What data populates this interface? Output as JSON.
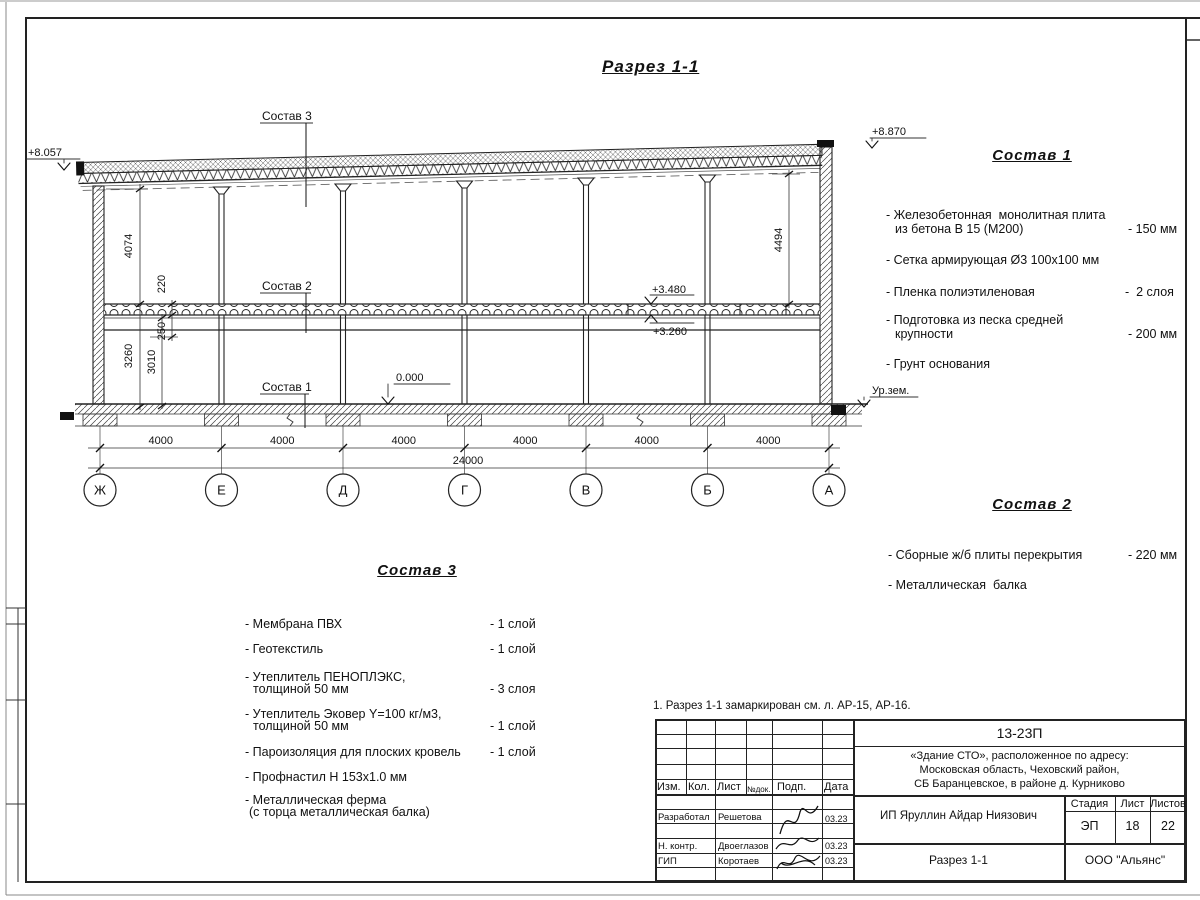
{
  "page": {
    "title": "Разрез 1-1",
    "note": "1. Разрез 1-1 замаркирован см. л. АР-15, АР-16."
  },
  "drawing": {
    "axes": [
      "Ж",
      "Е",
      "Д",
      "Г",
      "В",
      "Б",
      "А"
    ],
    "bay_dim": "4000",
    "total_dim": "24000",
    "dim_4074": "4074",
    "dim_4494": "4494",
    "dim_220": "220",
    "dim_250": "250",
    "dim_3010": "3010",
    "dim_3260": "3260",
    "elev_top_left": "+8.057",
    "elev_top_right": "+8.870",
    "elev_slab_top": "+3.480",
    "elev_slab_bottom": "+3.260",
    "elev_zero": "0.000",
    "ground_label": "Ур.зем.",
    "callout_1": "Состав 1",
    "callout_2": "Состав 2",
    "callout_3": "Состав 3"
  },
  "sostav1": {
    "title": "Состав 1",
    "items": [
      {
        "line1": "- Железобетонная  монолитная плита",
        "line2": "из бетона В 15 (М200)",
        "value": "- 150 мм"
      },
      {
        "line1": "- Сетка армирующая Ø3 100х100 мм",
        "line2": "",
        "value": ""
      },
      {
        "line1": "- Пленка полиэтиленовая",
        "line2": "",
        "value": "-  2 слоя"
      },
      {
        "line1": "- Подготовка из песка средней",
        "line2": "крупности",
        "value": "- 200 мм"
      },
      {
        "line1": "- Грунт основания",
        "line2": "",
        "value": ""
      }
    ]
  },
  "sostav2": {
    "title": "Состав 2",
    "items": [
      {
        "line1": "- Сборные ж/б плиты перекрытия",
        "value": "- 220 мм"
      },
      {
        "line1": "- Металлическая  балка",
        "value": ""
      }
    ]
  },
  "sostav3": {
    "title": "Состав 3",
    "items": [
      {
        "line1": "- Мембрана ПВХ",
        "line2": "",
        "value": "- 1 слой"
      },
      {
        "line1": "- Геотекстиль",
        "line2": "",
        "value": "- 1 слой"
      },
      {
        "line1": "- Утеплитель ПЕНОПЛЭКС,",
        "line2": "толщиной 50 мм",
        "value": "- 3 слоя"
      },
      {
        "line1": "- Утеплитель Эковер Y=100 кг/м3,",
        "line2": "толщиной 50 мм",
        "value": "- 1 слой"
      },
      {
        "line1": "- Пароизоляция для плоских кровель",
        "line2": "",
        "value": "- 1 слой"
      },
      {
        "line1": "- Профнастил Н 153х1.0 мм",
        "line2": "",
        "value": ""
      },
      {
        "line1": "- Металлическая ферма",
        "line2": "(с торца металлическая балка)",
        "value": ""
      }
    ]
  },
  "titleblock": {
    "doc_number": "13-23П",
    "address1": "«Здание СТО», расположенное по адресу:",
    "address2": "Московская область, Чеховский район,",
    "address3": "СБ Баранцевское, в районе д. Курниково",
    "col_izm": "Изм.",
    "col_kol": "Кол.",
    "col_list": "Лист",
    "col_ndok": "№док.",
    "col_podp": "Подп.",
    "col_data": "Дата",
    "row1_role": "Разработал",
    "row1_name": "Решетова",
    "row1_date": "03.23",
    "row2_role": "Н. контр.",
    "row2_name": "Двоеглазов",
    "row2_date": "03.23",
    "row3_role": "ГИП",
    "row3_name": "Коротаев",
    "row3_date": "03.23",
    "client": "ИП Яруллин Айдар Ниязович",
    "sheet_title": "Разрез 1-1",
    "org": "ООО \"Альянс\"",
    "stage_label": "Стадия",
    "list_label": "Лист",
    "listov_label": "Листов",
    "stage": "ЭП",
    "list": "18",
    "listov": "22"
  }
}
